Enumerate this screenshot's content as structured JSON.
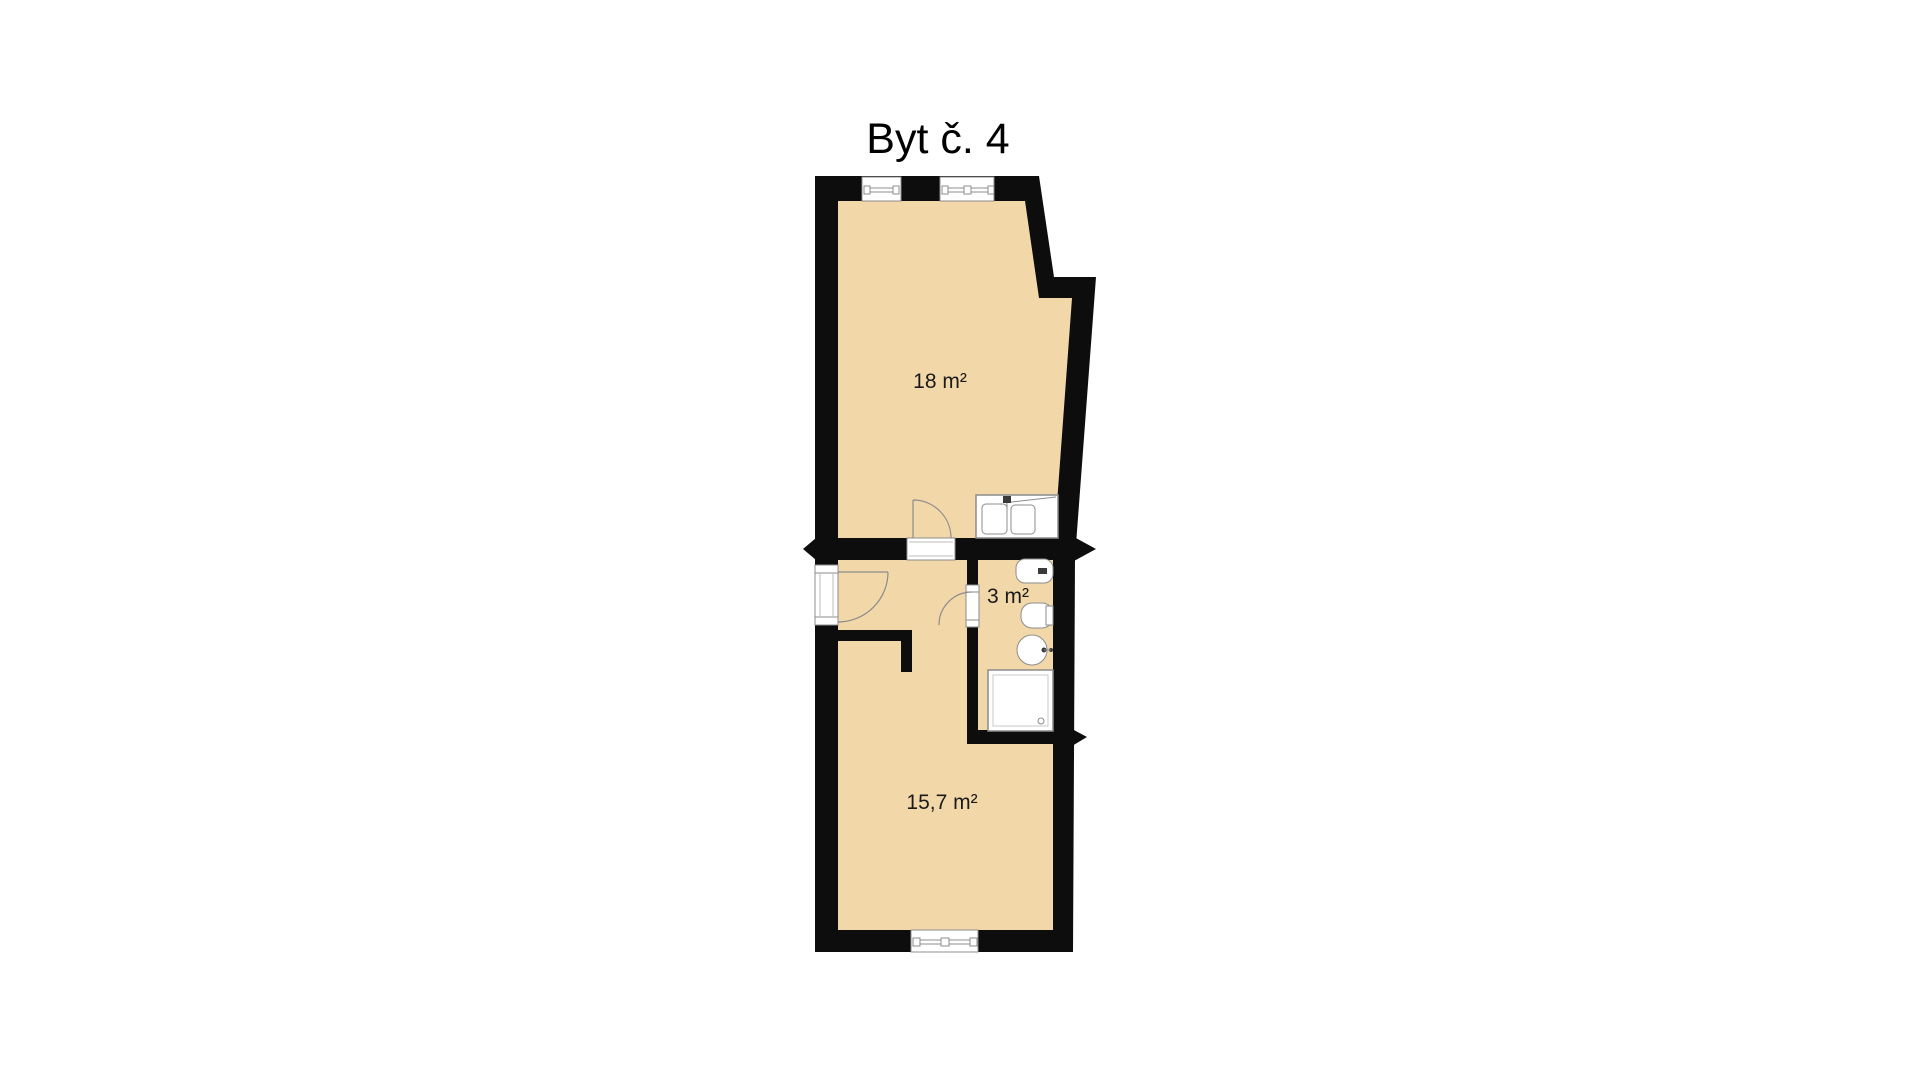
{
  "title": "Byt č. 4",
  "rooms": [
    {
      "id": "living-room",
      "area_label": "18 m²"
    },
    {
      "id": "bathroom",
      "area_label": "3 m²"
    },
    {
      "id": "bedroom",
      "area_label": "15,7 m²"
    }
  ],
  "colors": {
    "background": "#ffffff",
    "floor": "#f2d8a9",
    "wall": "#0d0d0d",
    "outline": "#8c8c8c",
    "label": "#1a1a1a"
  }
}
